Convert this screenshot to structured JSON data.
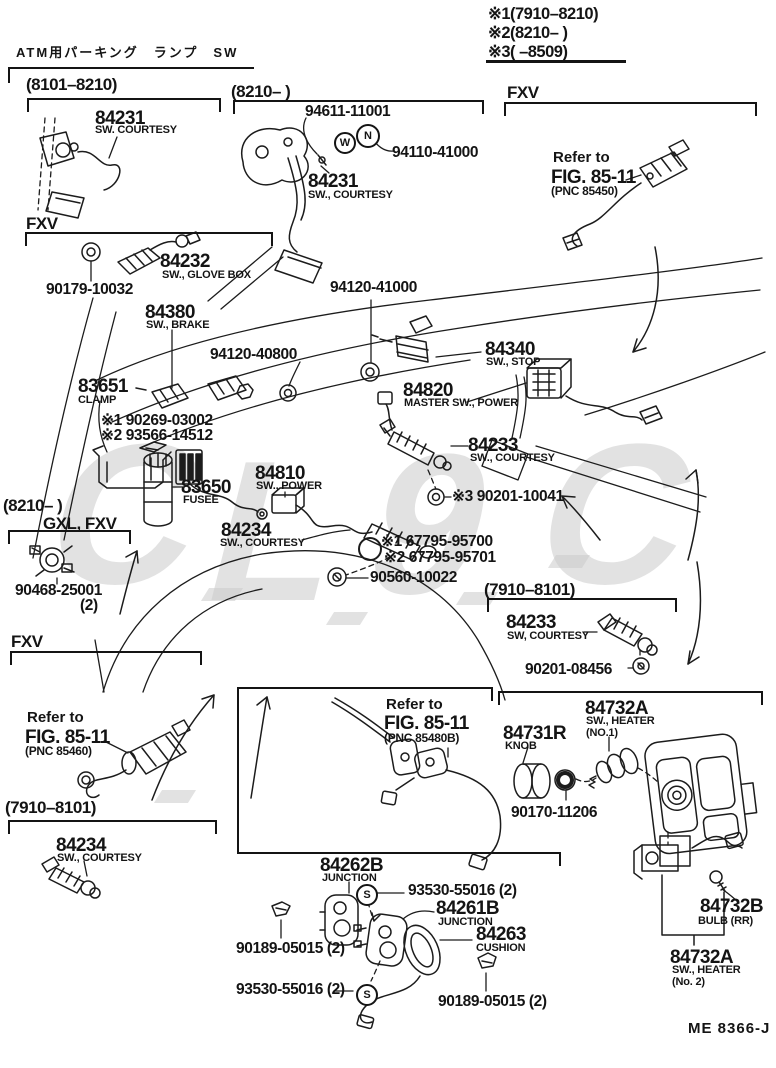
{
  "title": "ATM用パーキング　ランプ　SW",
  "footer": "ME 8366-J",
  "watermark": {
    "g1": "C",
    "g2": "L",
    "g3": "9",
    "g4": "C"
  },
  "legend": {
    "l1": "※1(7910–8210)",
    "l2": "※2(8210–      )",
    "l3": "※3(      –8509)"
  },
  "sections": {
    "s8101": "(8101–8210)",
    "s8210a": "(8210–        )",
    "fxv1": "FXV",
    "fxv2": "FXV",
    "s8210b": "(8210–        )",
    "gxl": "GXL, FXV",
    "s7910a": "(7910–8101)",
    "fxv3": "FXV",
    "s7910b": "(7910–8101)"
  },
  "refs": {
    "r1": {
      "t": "Refer to",
      "f": "FIG. 85-11",
      "p": "(PNC 85450)"
    },
    "r2": {
      "t": "Refer to",
      "f": "FIG. 85-11",
      "p": "(PNC 85460)"
    },
    "r3": {
      "t": "Refer to",
      "f": "FIG. 85-11",
      "p": "(PNC 85480B)"
    }
  },
  "glyphs": {
    "w": "W",
    "n": "N",
    "s1": "S",
    "s2": "S"
  },
  "parts": {
    "p84231a": {
      "num": "84231",
      "d": "SW. COURTESY"
    },
    "p94611": {
      "num": "94611-11001"
    },
    "p94110": {
      "num": "94110-41000"
    },
    "p84231b": {
      "num": "84231",
      "d": "SW., COURTESY"
    },
    "p84232": {
      "num": "84232",
      "d": "SW., GLOVE BOX"
    },
    "p90179": {
      "num": "90179-10032"
    },
    "p84380": {
      "num": "84380",
      "d": "SW., BRAKE"
    },
    "p94120a": {
      "num": "94120-41000"
    },
    "p94120b": {
      "num": "94120-40800"
    },
    "p84340": {
      "num": "84340",
      "d": "SW., STOP"
    },
    "p83651": {
      "num": "83651",
      "d": "CLAMP"
    },
    "p90269": {
      "num": "※1 90269-03002"
    },
    "p93566": {
      "num": "※2 93566-14512"
    },
    "p84820": {
      "num": "84820",
      "d": "MASTER SW., POWER"
    },
    "p84233a": {
      "num": "84233",
      "d": "SW., COURTESY"
    },
    "p83650": {
      "num": "83650",
      "d": "FUSEE"
    },
    "p84810": {
      "num": "84810",
      "d": "SW., POWER"
    },
    "p90201a": {
      "num": "※3 90201-10041"
    },
    "p84234a": {
      "num": "84234",
      "d": "SW., COURTESY"
    },
    "p67795a": {
      "num": "※1 67795-95700"
    },
    "p67795b": {
      "num": "※2 67795-95701"
    },
    "p90560": {
      "num": "90560-10022"
    },
    "p90468": {
      "num": "90468-25001",
      "d": "(2)"
    },
    "p84233b": {
      "num": "84233",
      "d": "SW, COURTESY"
    },
    "p90201b": {
      "num": "90201-08456"
    },
    "p84234b": {
      "num": "84234",
      "d": "SW., COURTESY"
    },
    "p84731": {
      "num": "84731R",
      "d": "KNOB"
    },
    "p84732a1": {
      "num": "84732A",
      "d": "SW., HEATER",
      "d2": "(NO.1)"
    },
    "p90170": {
      "num": "90170-11206"
    },
    "p84262": {
      "num": "84262B",
      "d": "JUNCTION"
    },
    "p93530a": {
      "num": "93530-55016 (2)"
    },
    "p84261": {
      "num": "84261B",
      "d": "JUNCTION"
    },
    "p84263": {
      "num": "84263",
      "d": "CUSHION"
    },
    "p90189a": {
      "num": "90189-05015 (2)"
    },
    "p93530b": {
      "num": "93530-55016 (2)"
    },
    "p90189b": {
      "num": "90189-05015 (2)"
    },
    "p84732b": {
      "num": "84732B",
      "d": "BULB (RR)"
    },
    "p84732a2": {
      "num": "84732A",
      "d": "SW., HEATER",
      "d2": "(No. 2)"
    }
  }
}
